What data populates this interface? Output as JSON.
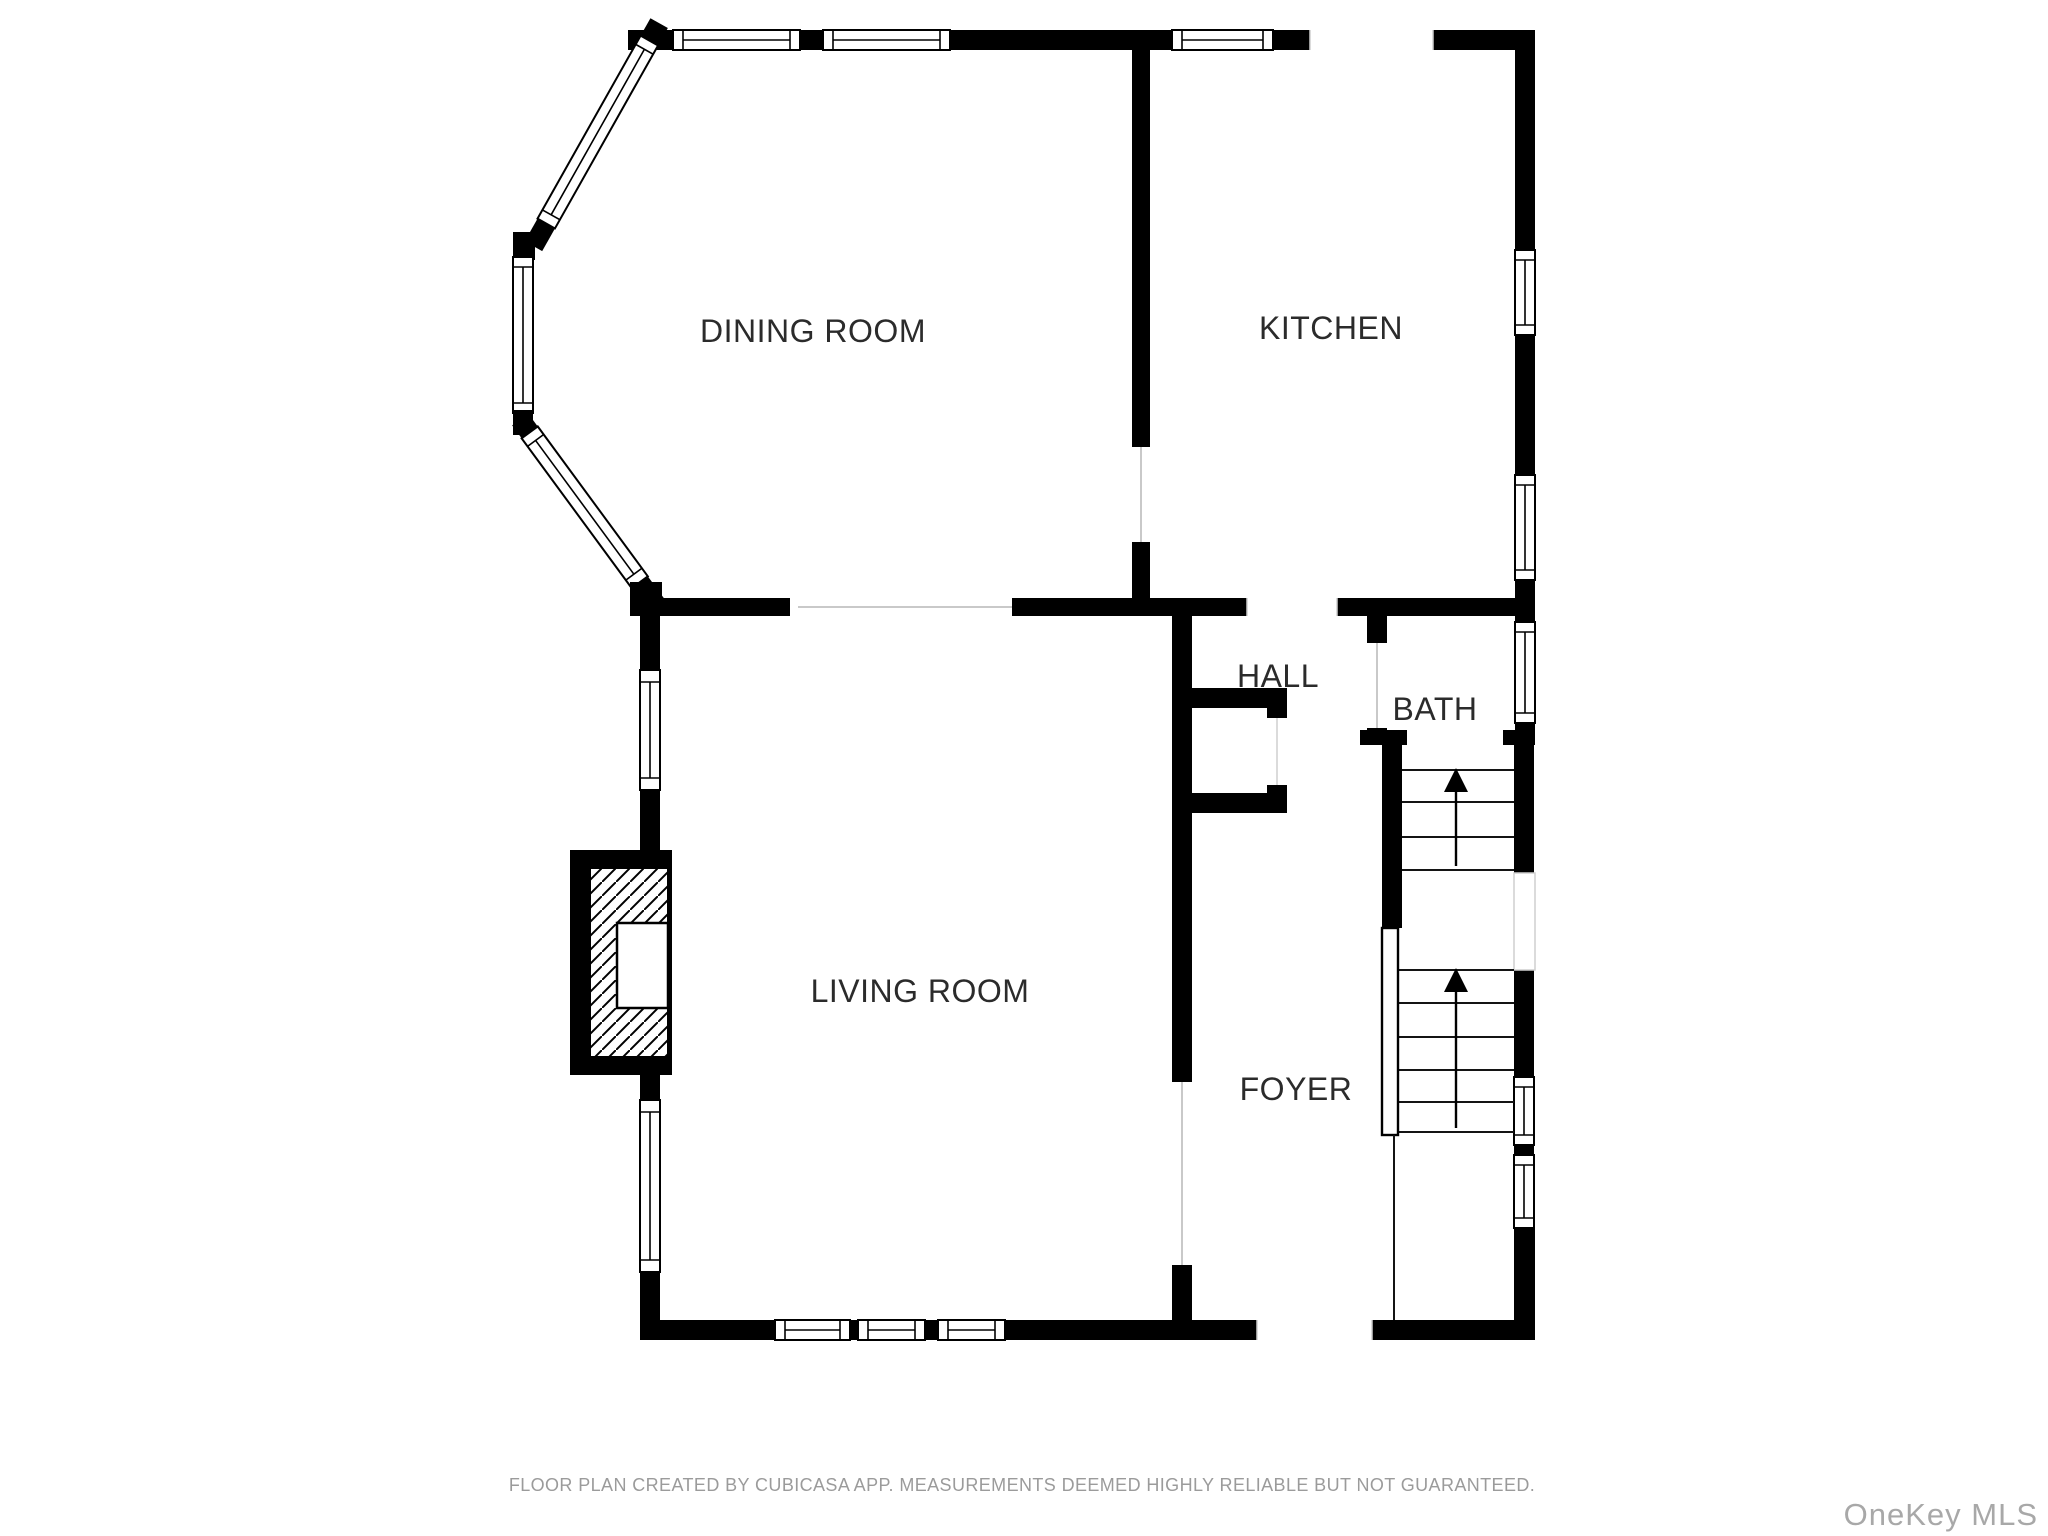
{
  "floor_plan": {
    "rooms": [
      {
        "id": "dining-room",
        "label": "DINING ROOM"
      },
      {
        "id": "kitchen",
        "label": "KITCHEN"
      },
      {
        "id": "hall",
        "label": "HALL"
      },
      {
        "id": "bath",
        "label": "BATH"
      },
      {
        "id": "living-room",
        "label": "LIVING ROOM"
      },
      {
        "id": "foyer",
        "label": "FOYER"
      }
    ],
    "features": {
      "staircase": {
        "flights": 2,
        "direction_icon": "up-arrow"
      },
      "bay_window": "bay-window",
      "fireplace": "fireplace-hatched",
      "closet": "hall-closet"
    },
    "colors": {
      "wall": "#000000",
      "background": "#ffffff",
      "room_label": "#2b2b2b",
      "opening_line": "#c9c9c9",
      "footer_text": "#9b9b9b",
      "watermark_text": "#a8a8a8"
    }
  },
  "footer": {
    "disclaimer": "FLOOR PLAN CREATED BY CUBICASA APP. MEASUREMENTS DEEMED HIGHLY RELIABLE BUT NOT GUARANTEED."
  },
  "watermark": {
    "text": "OneKey MLS"
  }
}
